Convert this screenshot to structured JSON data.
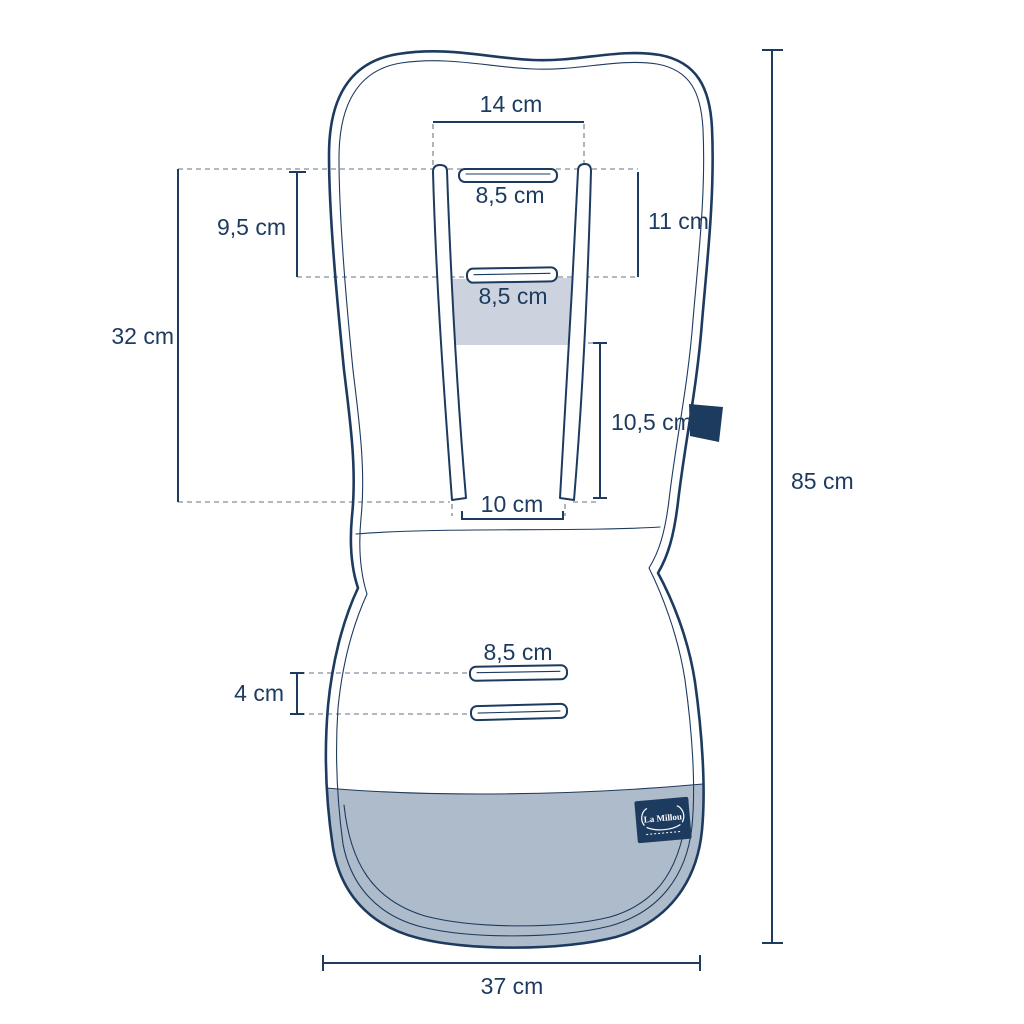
{
  "diagram": {
    "product": "stroller-pad-size-diagram",
    "brand_label": "La Millou",
    "colors": {
      "line_navy": "#1d3a5f",
      "guide_gray": "#98a2ae",
      "seat_fill": "#aebbca",
      "panel_fill": "#ccd3de",
      "tab_navy": "#1d3a5f",
      "background": "#ffffff"
    },
    "dimensions": {
      "top_slot_span": "14 cm",
      "top_slot_width": "8,5 cm",
      "headrest_height": "9,5 cm",
      "top_slots_gap": "11 cm",
      "mid_slot_width": "8,5 cm",
      "backrest_height": "32 cm",
      "lower_strap_length": "10,5 cm",
      "strap_bottom_gap": "10 cm",
      "seat_slot_width": "8,5 cm",
      "seat_slots_gap": "4 cm",
      "total_length": "85 cm",
      "total_width": "37 cm"
    }
  }
}
